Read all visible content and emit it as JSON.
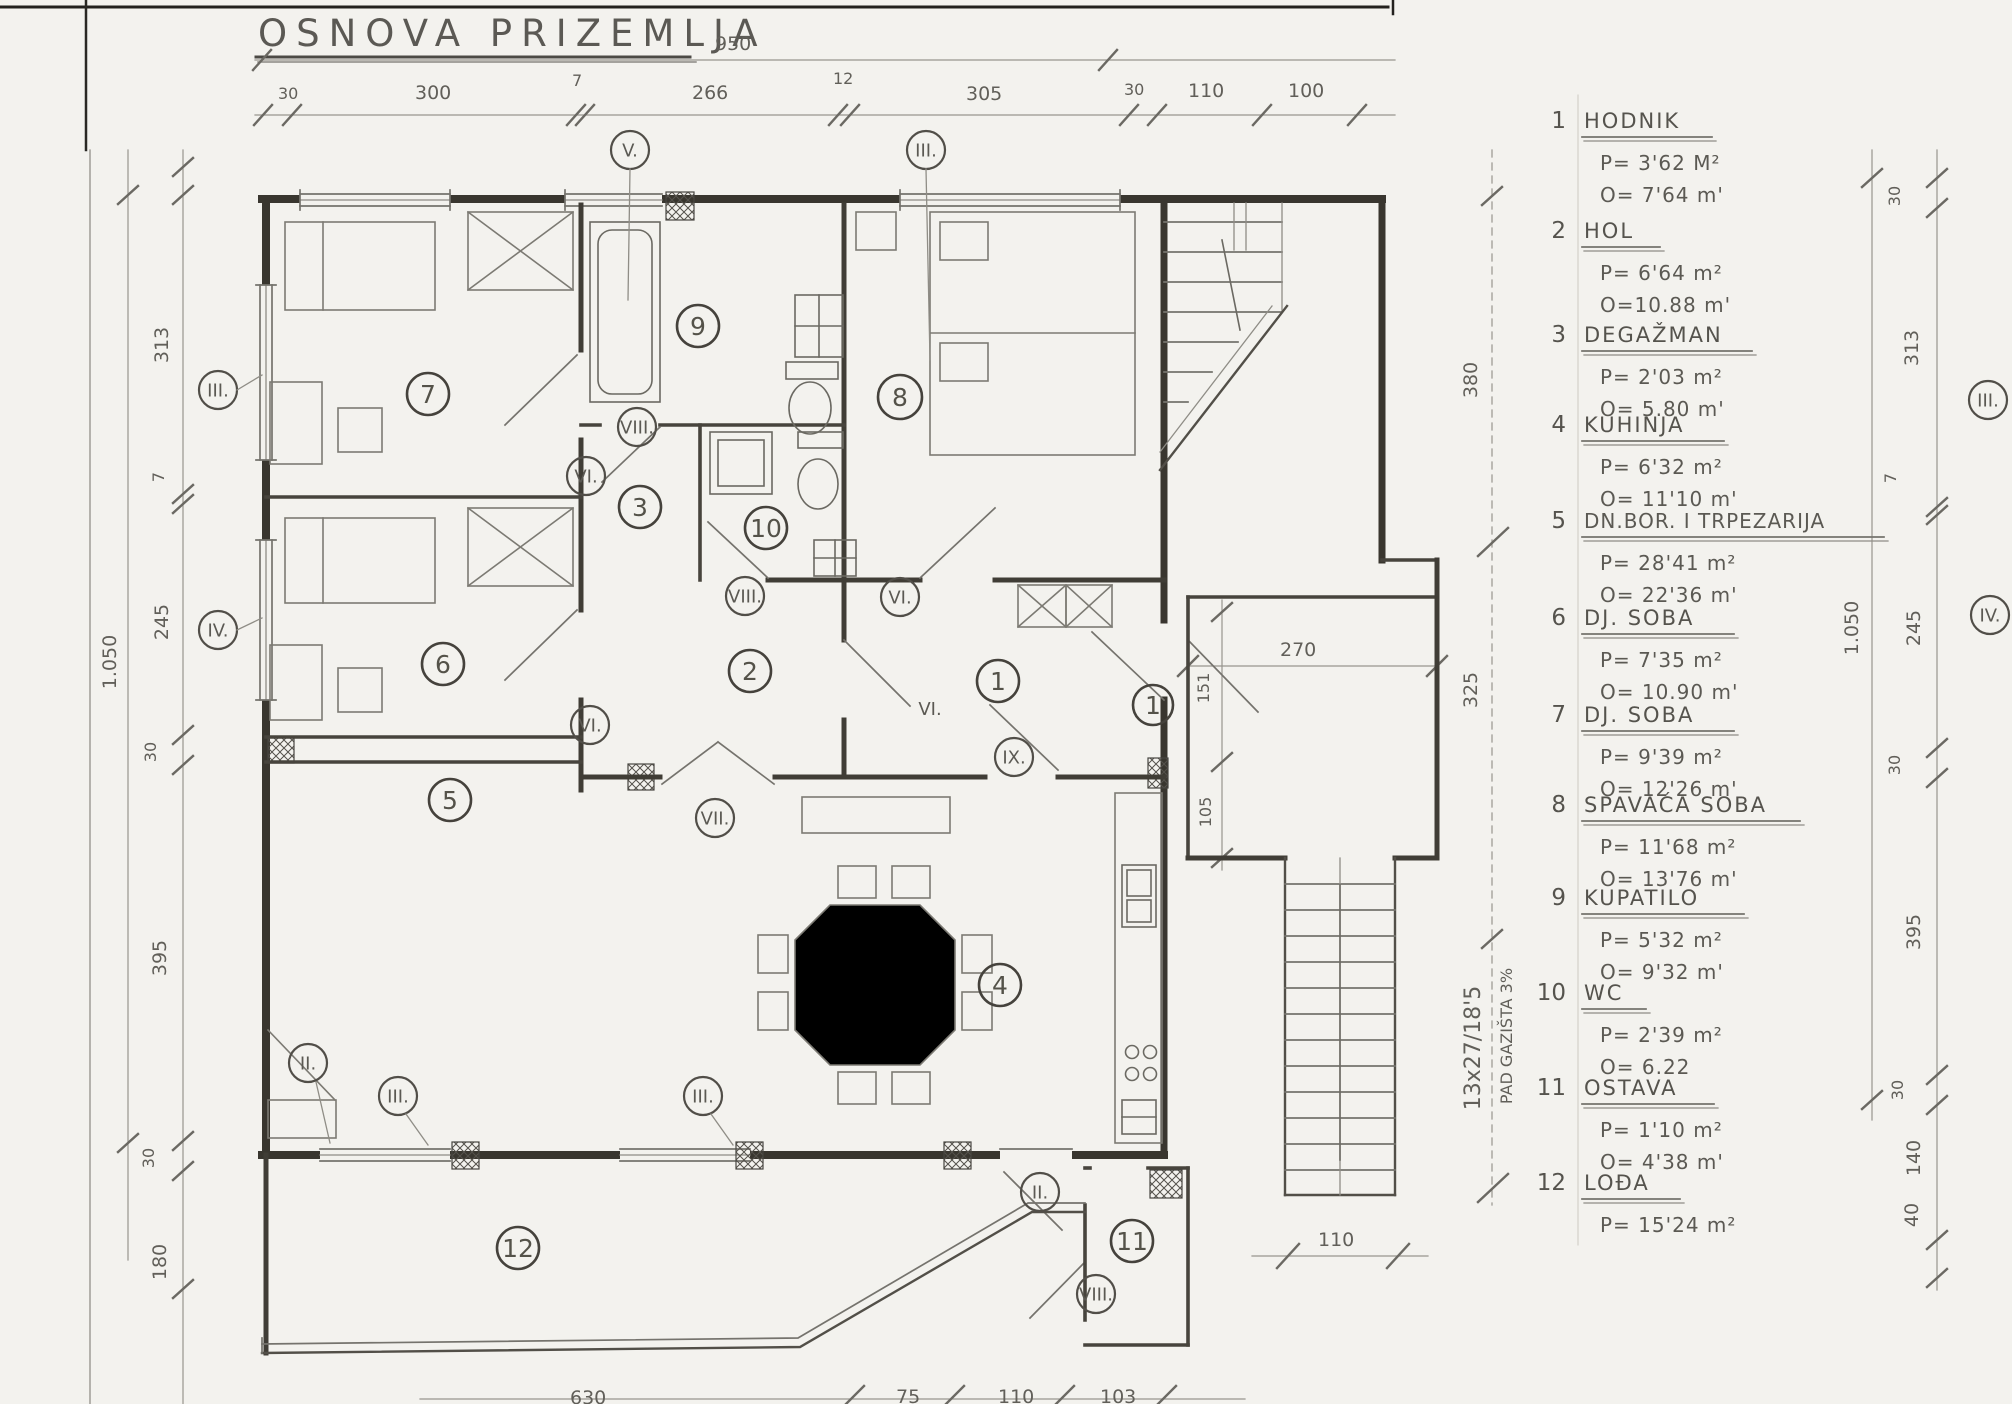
{
  "title": "OSNOVA PRIZEMLJA",
  "dims": {
    "top_total": "950",
    "top": [
      "30",
      "300",
      "7",
      "266",
      "12",
      "305",
      "30",
      "110",
      "100"
    ],
    "left_total": "1.050",
    "left": [
      "313",
      "7",
      "245",
      "30",
      "395",
      "30",
      "180"
    ],
    "right_total": "1.050",
    "right": [
      "30",
      "313",
      "7",
      "245",
      "30",
      "395",
      "30",
      "140",
      "40"
    ],
    "inner_right": [
      "380",
      "325"
    ],
    "entry": [
      "270",
      "151",
      "105"
    ],
    "stairs_width": "110",
    "bottom": [
      "630",
      "75",
      "110",
      "103"
    ]
  },
  "notes": {
    "stair_formula": "13x27/18'5",
    "stair_slope": "PAD GAZIŠTA 3%"
  },
  "rooms": {
    "n1": "1",
    "n2": "2",
    "n3": "3",
    "n4": "4",
    "n5": "5",
    "n6": "6",
    "n7": "7",
    "n8": "8",
    "n9": "9",
    "n10": "10",
    "n11": "11",
    "n12": "12"
  },
  "types": {
    "II": "II.",
    "III": "III.",
    "IV": "IV.",
    "V": "V.",
    "VI": "VI.",
    "VII": "VII.",
    "VIII": "VIII.",
    "IX": "IX."
  },
  "legend": {
    "items": [
      {
        "num": "1",
        "name": "HODNIK",
        "p": "P= 3'62 M²",
        "o": "O= 7'64 m'"
      },
      {
        "num": "2",
        "name": "HOL",
        "p": "P= 6'64 m²",
        "o": "O=10.88 m'"
      },
      {
        "num": "3",
        "name": "DEGAŽMAN",
        "p": "P= 2'03 m²",
        "o": "O= 5.80 m'"
      },
      {
        "num": "4",
        "name": "KUHINJA",
        "p": "P= 6'32 m²",
        "o": "O= 11'10 m'"
      },
      {
        "num": "5",
        "name": "DN.BOR. I TRPEZARIJA",
        "p": "P= 28'41 m²",
        "o": "O= 22'36 m'"
      },
      {
        "num": "6",
        "name": "DJ. SOBA",
        "p": "P= 7'35 m²",
        "o": "O= 10.90 m'"
      },
      {
        "num": "7",
        "name": "DJ. SOBA",
        "p": "P= 9'39 m²",
        "o": "O= 12'26 m'"
      },
      {
        "num": "8",
        "name": "SPAVAĆA SOBA",
        "p": "P= 11'68 m²",
        "o": "O= 13'76 m'"
      },
      {
        "num": "9",
        "name": "KUPATILO",
        "p": "P= 5'32 m²",
        "o": "O= 9'32 m'"
      },
      {
        "num": "10",
        "name": "WC",
        "p": "P= 2'39 m²",
        "o": "O= 6.22"
      },
      {
        "num": "11",
        "name": "OSTAVA",
        "p": "P= 1'10 m²",
        "o": "O= 4'38 m'"
      },
      {
        "num": "12",
        "name": "LOĐA",
        "p": "P= 15'24 m²",
        "o": ""
      }
    ]
  }
}
